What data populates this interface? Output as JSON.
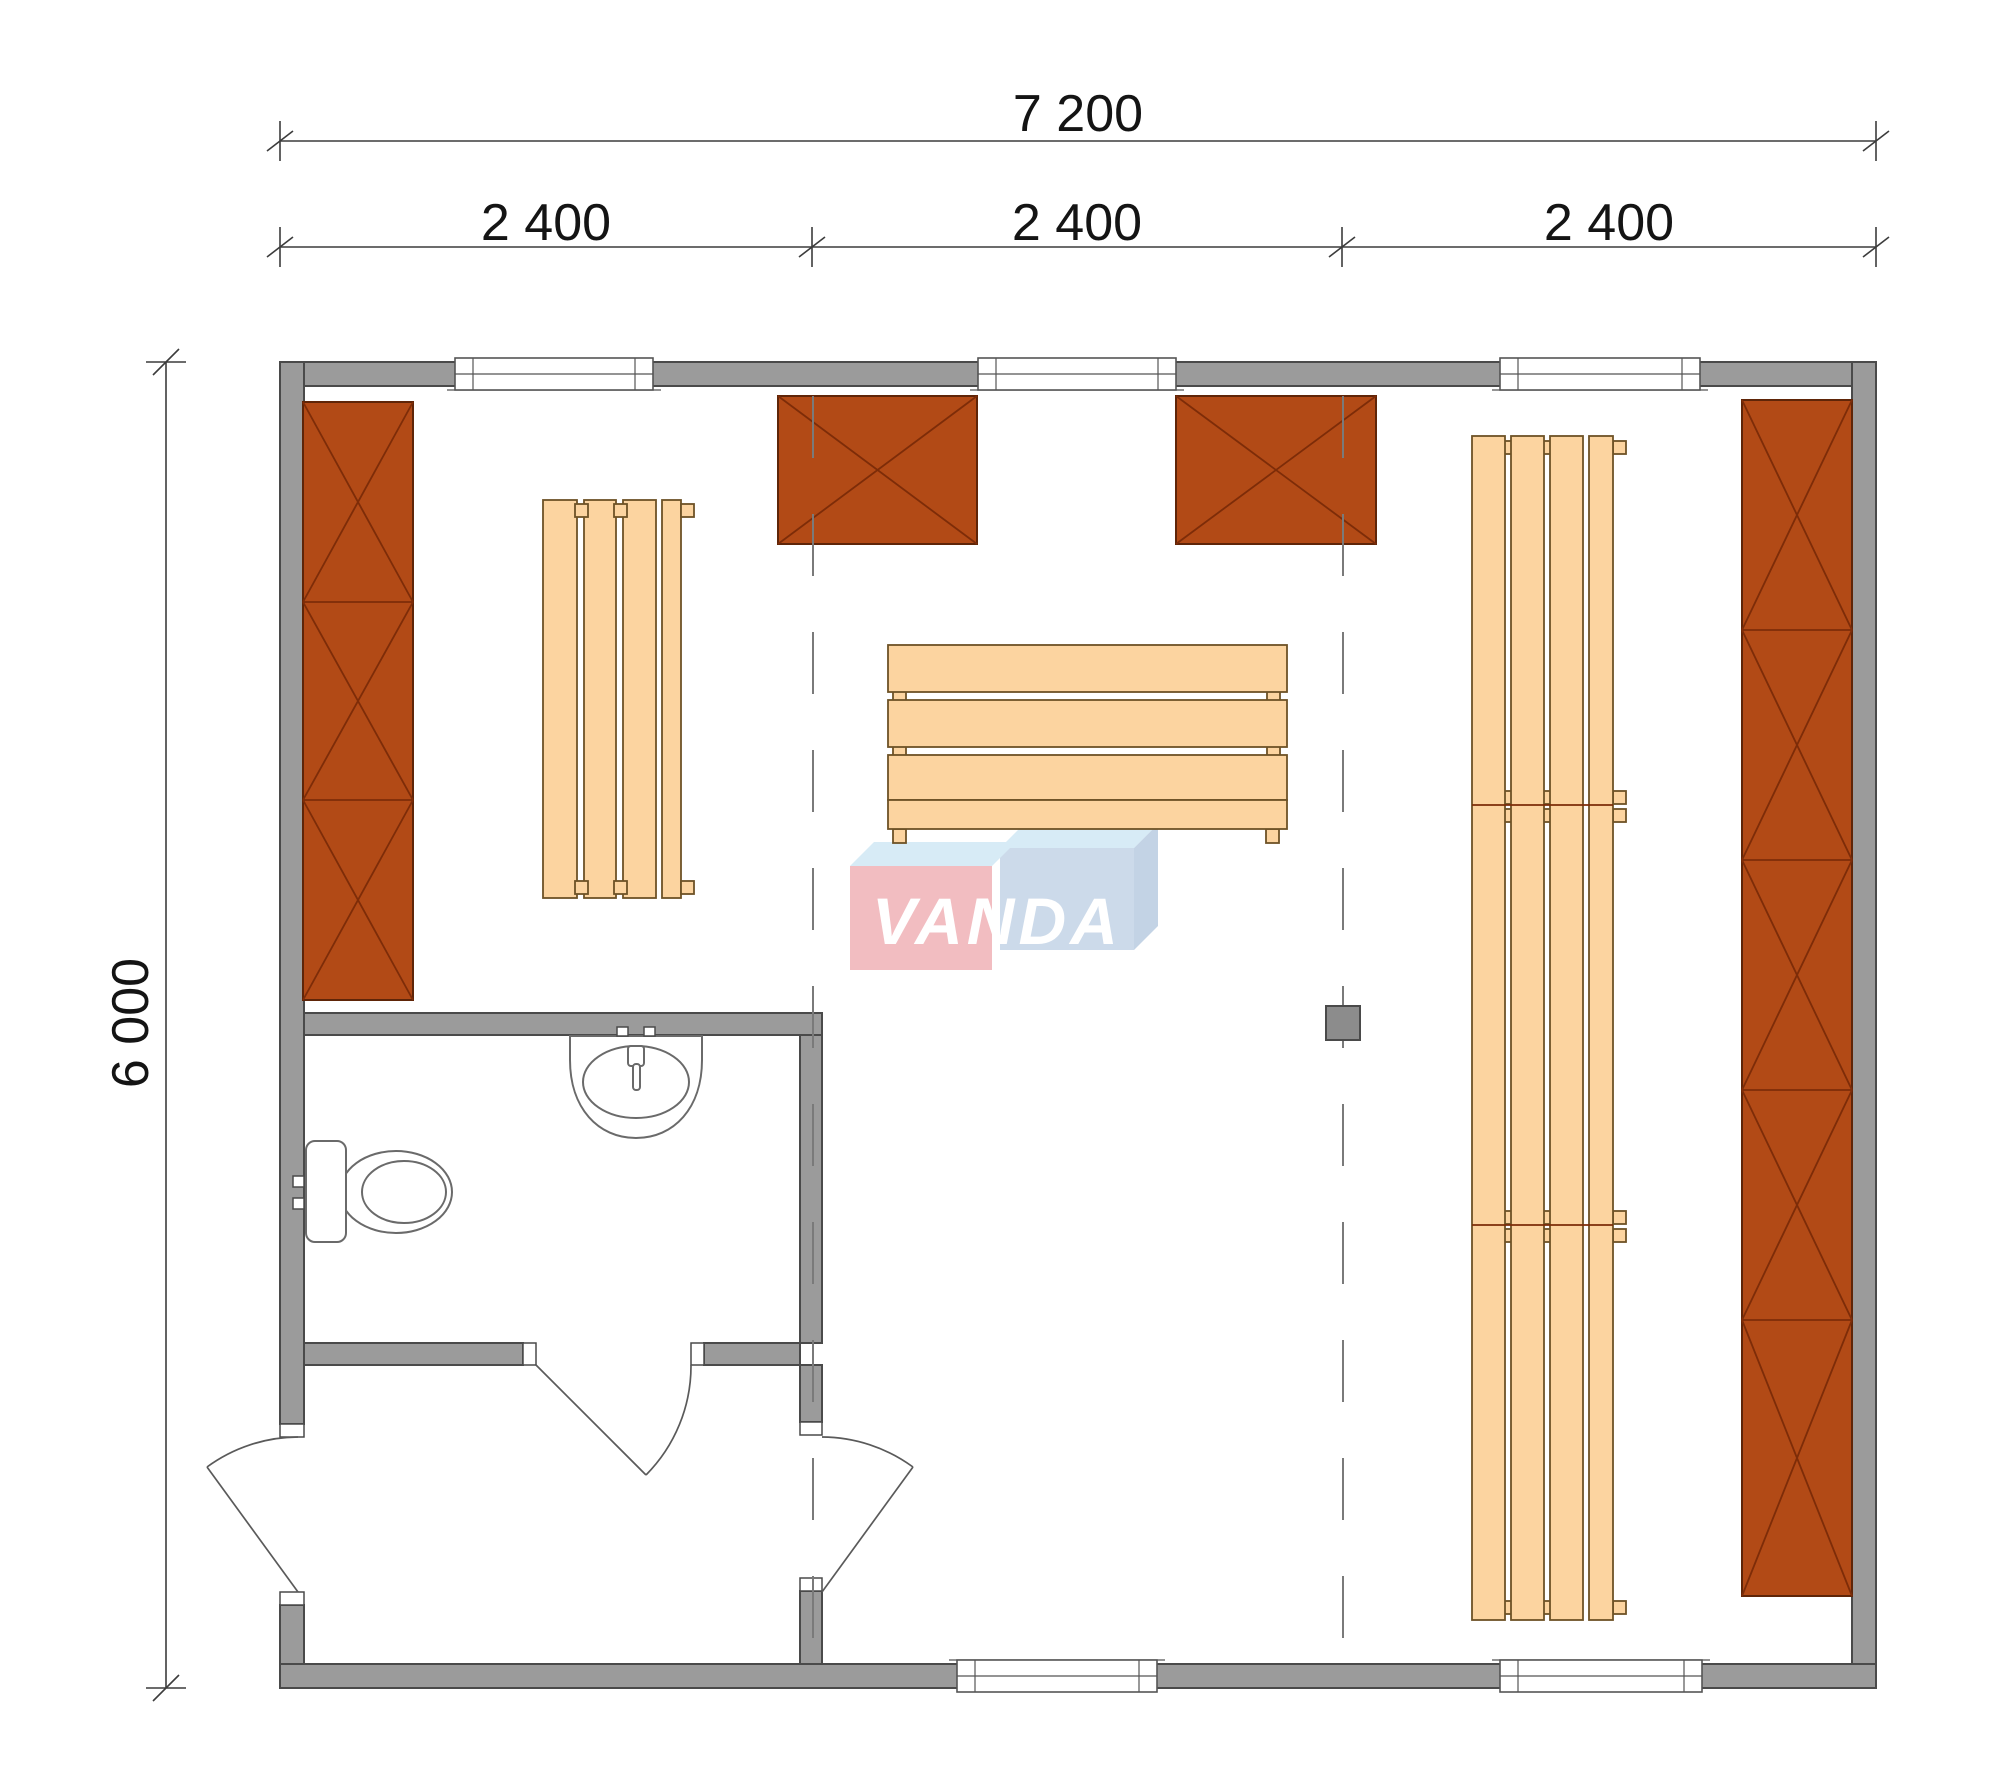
{
  "document": {
    "type": "modular-building-floor-plan",
    "background": "#ffffff"
  },
  "dimensions": {
    "top_total": "7 200",
    "modules": [
      "2 400",
      "2 400",
      "2 400"
    ],
    "left_total": "6 000"
  },
  "watermark": {
    "text": "VANDA",
    "van_block_color": "#f2bdc1",
    "da_block_color": "#ccdaea",
    "bevel_color": "#d7ebf6",
    "side_color": "#c3d3e5",
    "text_color": "#ffffff"
  },
  "colors": {
    "wall": "#9b9b9b",
    "wall_outline": "#4a4a4a",
    "cabinet": "#b24a16",
    "cabinet_outline": "#5f2508",
    "bench": "#fcd4a0",
    "bench_outline": "#6d5226",
    "stove": "#8c8c8c",
    "module_line": "#7a7a7a",
    "dimension_line": "#3c3c3c",
    "dimension_text": "#141414",
    "fixture_outline": "#6a6a6a"
  }
}
